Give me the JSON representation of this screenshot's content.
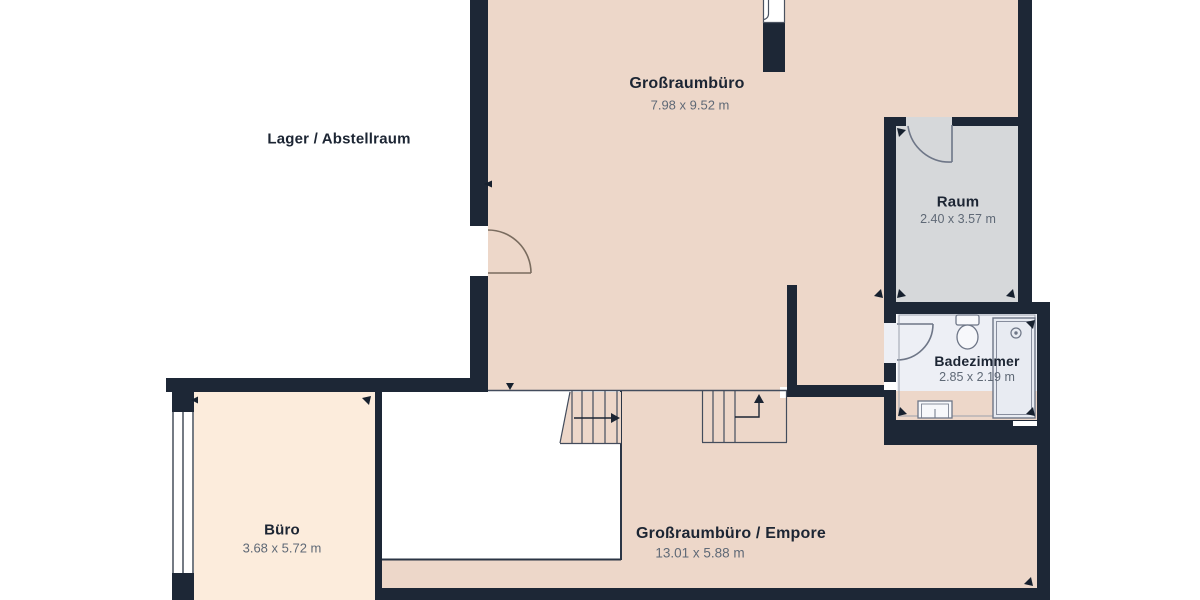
{
  "colors": {
    "wall": "#1d2736",
    "floor_main": "#edd7c9",
    "floor_office": "#fcecdc",
    "floor_room": "#d6d8da",
    "floor_bath": "#edeff5",
    "outline": "#2b3545",
    "stair_line": "#434c5c",
    "door_line": "#7a6c5f",
    "fixture_line": "#6e7687",
    "label": "#1c2533",
    "dims": "#5f6976"
  },
  "rooms": {
    "lager": {
      "name": "Lager / Abstellraum"
    },
    "grossraumbuero": {
      "name": "Großraumbüro",
      "dims": "7.98 x 9.52 m"
    },
    "raum": {
      "name": "Raum",
      "dims": "2.40 x 3.57 m"
    },
    "badezimmer": {
      "name": "Badezimmer",
      "dims": "2.85 x 2.19 m"
    },
    "buero": {
      "name": "Büro",
      "dims": "3.68 x 5.72 m"
    },
    "empore": {
      "name": "Großraumbüro / Empore",
      "dims": "13.01 x 5.88 m"
    }
  }
}
